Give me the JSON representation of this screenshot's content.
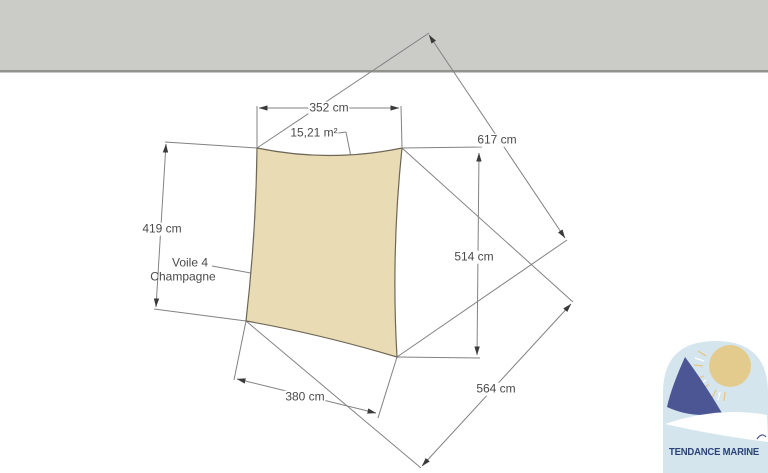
{
  "drawing": {
    "labels": {
      "area": "15,21 m²",
      "name_line1": "Voile 4",
      "name_line2": "Champagne",
      "dim_top": "352 cm",
      "dim_left": "419 cm",
      "dim_right": "514 cm",
      "dim_bottom": "380 cm",
      "dim_diagonal_long": "617 cm",
      "dim_diagonal_short": "564 cm"
    },
    "colors": {
      "sail_fill": "#e9dcb4",
      "sail_stroke": "#6e6757",
      "wall_fill": "#cbcbc7",
      "wall_edge": "#93938d",
      "line": "#828282",
      "text": "#4a4a4a"
    }
  },
  "logo": {
    "brand": "TENDANCE MARINE",
    "colors": {
      "sky": "#d5e5ee",
      "navy": "#4c5695",
      "gold": "#e3cb8e",
      "text": "#2b4376"
    }
  }
}
